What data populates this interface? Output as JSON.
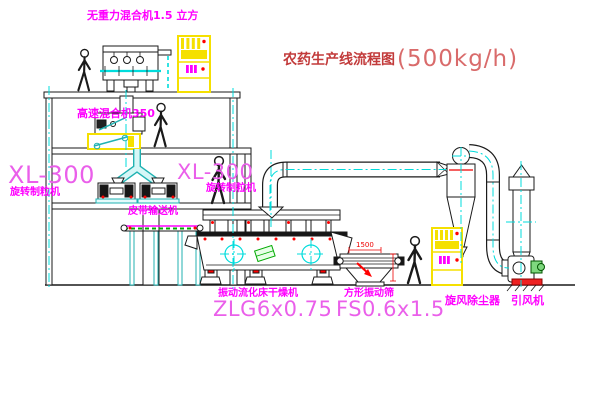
{
  "title": {
    "text": "农药生产线流程图",
    "capacity": "(500kg/h)"
  },
  "labels": {
    "gravity_mixer": "无重力混合机1.5 立方",
    "high_speed_mixer": "高速混合机350",
    "granulator_left_model": "XL-300",
    "granulator_left_name": "旋转制粒机",
    "granulator_right_model": "XL-300",
    "granulator_right_name": "旋转制粒机",
    "belt_conveyor": "皮带输送机",
    "dryer_name": "振动流化床干燥机",
    "dryer_model": "ZLG6x0.75",
    "screen_name": "方形振动筛",
    "screen_model": "FS0.6x1.5",
    "cyclone_name": "旋风除尘器",
    "fan_name": "引风机",
    "screen_dim": "1500"
  },
  "colors": {
    "label_magenta": "#ff00ff",
    "model_pink": "#ea5fea",
    "title_red": "#c23b3b",
    "centerline_cyan": "#00dcdc",
    "cabinet_yellow": "#f5e000",
    "alert_red": "#ff0000",
    "detail_green": "#00aa00"
  }
}
